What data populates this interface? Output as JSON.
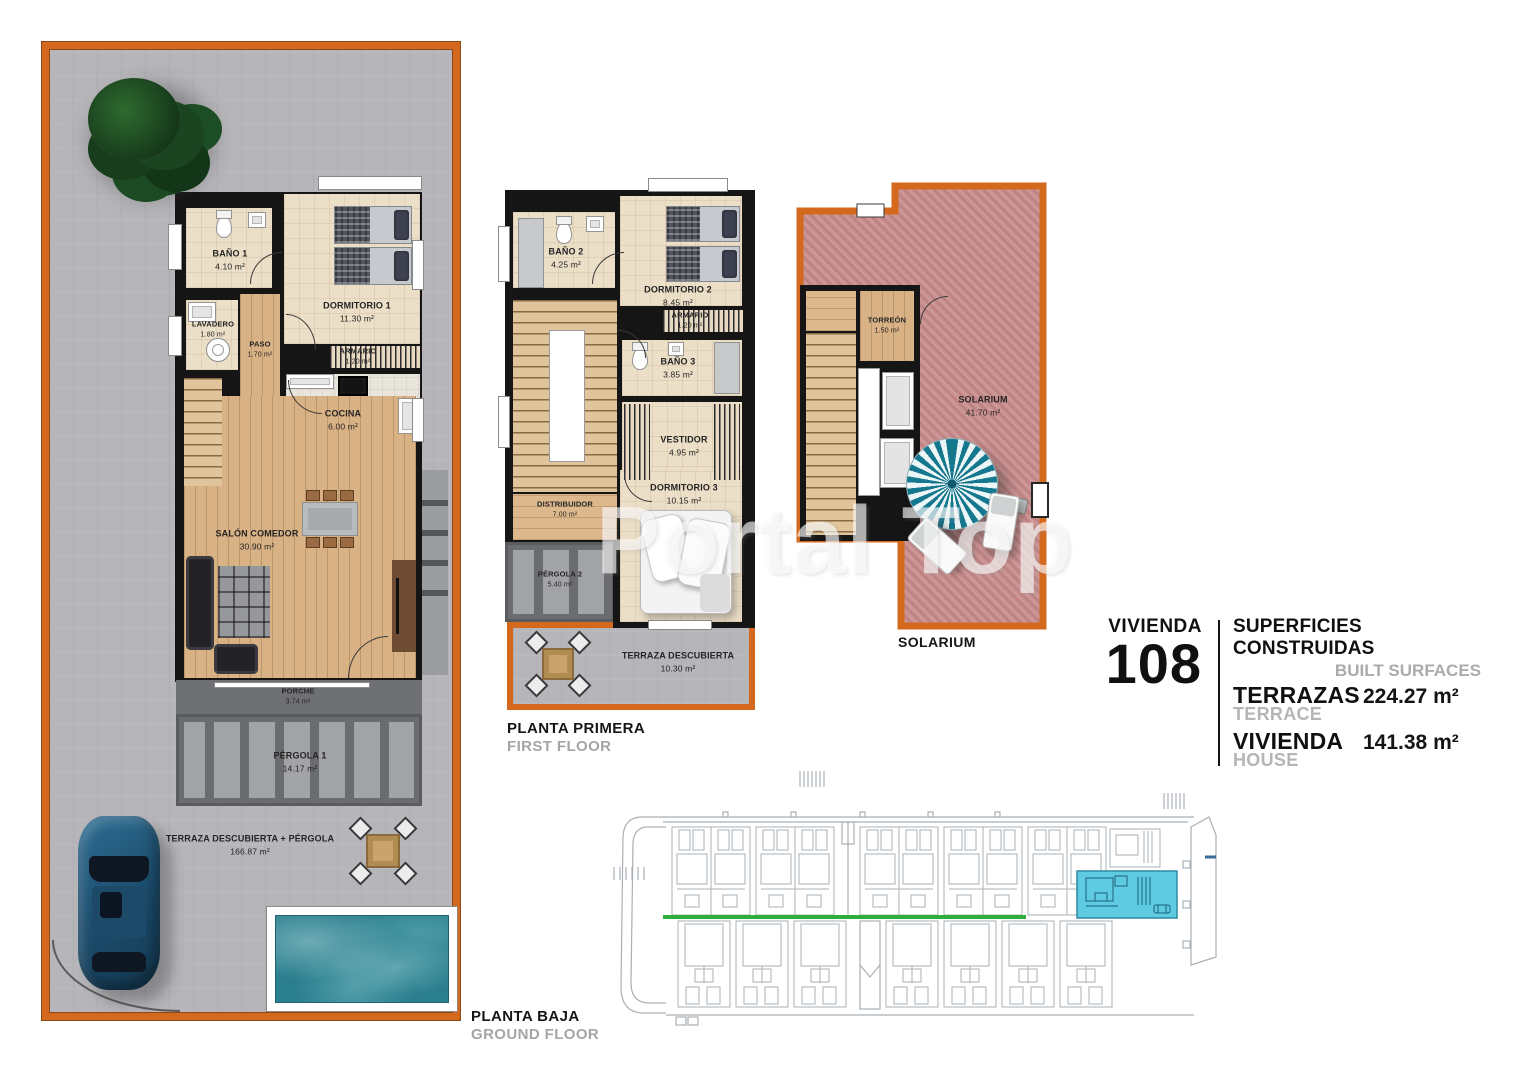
{
  "watermark": "Portal Top",
  "info_panel": {
    "unit_label": "VIVIENDA",
    "unit_number": "108",
    "surfaces_title": "SUPERFICIES CONSTRUIDAS",
    "surfaces_title_en": "BUILT SURFACES",
    "terrace_label": "TERRAZAS",
    "terrace_label_en": "TERRACE",
    "terrace_value": "224.27 m²",
    "house_label": "VIVIENDA",
    "house_label_en": "HOUSE",
    "house_value": "141.38 m²"
  },
  "ground_floor": {
    "caption": "PLANTA BAJA",
    "caption_en": "GROUND FLOOR",
    "rooms": {
      "bano1": {
        "name": "BAÑO 1",
        "area": "4.10 m²"
      },
      "lavadero": {
        "name": "LAVADERO",
        "area": "1.80 m²"
      },
      "paso": {
        "name": "PASO",
        "area": "1.70 m²"
      },
      "dormitorio1": {
        "name": "DORMITORIO 1",
        "area": "11.30 m²"
      },
      "armario": {
        "name": "ARMARIO",
        "area": "1.20 m²"
      },
      "cocina": {
        "name": "COCINA",
        "area": "6.00 m²"
      },
      "salon": {
        "name": "SALÓN COMEDOR",
        "area": "30.90 m²"
      },
      "porche": {
        "name": "PORCHE",
        "area": "3.74 m²"
      },
      "pergola1": {
        "name": "PÉRGOLA 1",
        "area": "14.17 m²"
      },
      "terraza": {
        "name": "TERRAZA DESCUBIERTA + PÉRGOLA",
        "area": "166.87 m²"
      }
    }
  },
  "first_floor": {
    "caption": "PLANTA PRIMERA",
    "caption_en": "FIRST FLOOR",
    "rooms": {
      "bano2": {
        "name": "BAÑO 2",
        "area": "4.25 m²"
      },
      "dormitorio2": {
        "name": "DORMITORIO 2",
        "area": "8.45 m²"
      },
      "armario2": {
        "name": "ARMARIO",
        "area": "1.20 m²"
      },
      "bano3": {
        "name": "BAÑO 3",
        "area": "3.85 m²"
      },
      "vestidor": {
        "name": "VESTIDOR",
        "area": "4.95 m²"
      },
      "distribuidor": {
        "name": "DISTRIBUIDOR",
        "area": "7.00 m²"
      },
      "dormitorio3": {
        "name": "DORMITORIO 3",
        "area": "10.15 m²"
      },
      "pergola2": {
        "name": "PÉRGOLA 2",
        "area": "5.40 m²"
      },
      "terraza2": {
        "name": "TERRAZA DESCUBIERTA",
        "area": "10.30 m²"
      }
    }
  },
  "solarium_floor": {
    "caption": "SOLARIUM",
    "rooms": {
      "torreon": {
        "name": "TORREÓN",
        "area": "1.50 m²"
      },
      "solarium": {
        "name": "SOLARIUM",
        "area": "41.70 m²"
      }
    }
  },
  "colors": {
    "accent_orange": "#d4681c",
    "highlight_cyan": "#5fcbe2",
    "site_green": "#2fae3c",
    "solarium_rose": "#c99090",
    "pool_teal": "#2a7e8e"
  }
}
